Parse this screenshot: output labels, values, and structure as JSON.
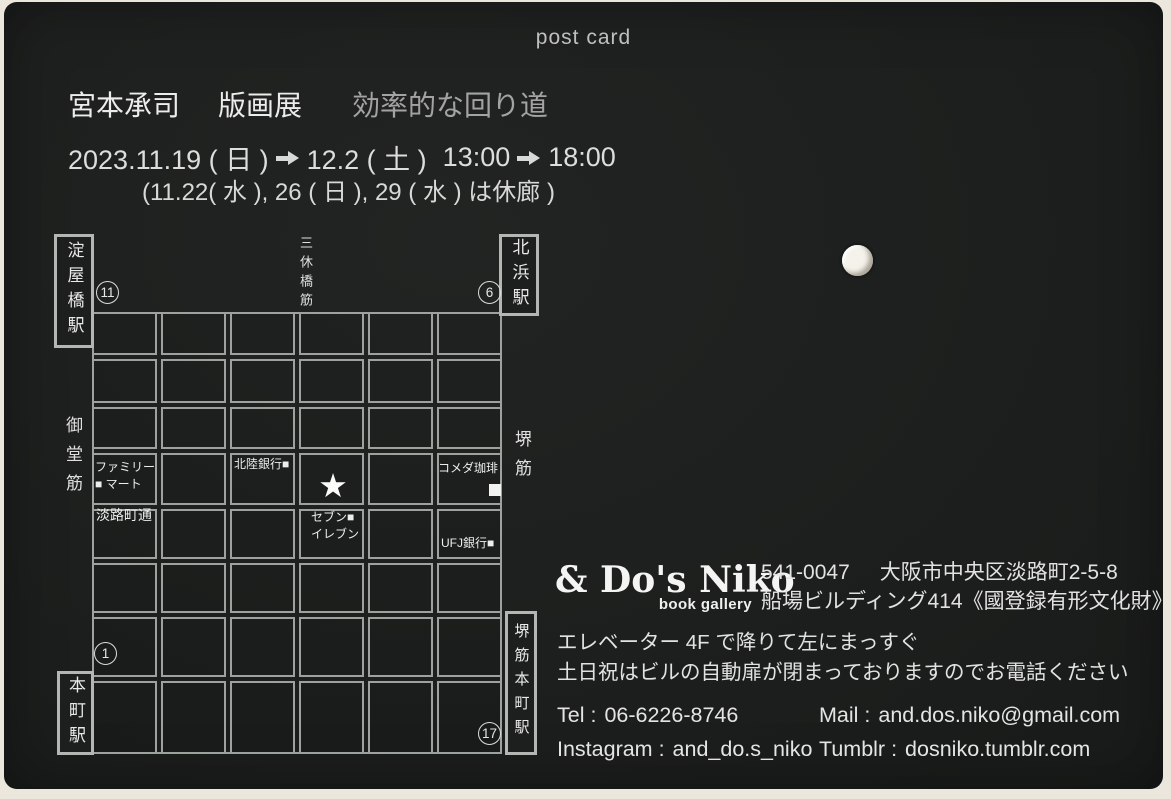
{
  "card": {
    "postcard_label": "post card",
    "title": {
      "artist": "宮本承司",
      "exhibition": "版画展",
      "subtitle": "効率的な回り道"
    },
    "dates": {
      "start": "2023.11.19 ( 日 )",
      "end": "12.2 ( 土 )",
      "open_time": "13:00",
      "close_time": "18:00",
      "closed_note": "(11.22( 水 ), 26 ( 日 ), 29 ( 水 ) は休廊 )"
    }
  },
  "map": {
    "stations": {
      "top_left": {
        "name": "淀屋橋駅",
        "exit": "11"
      },
      "top_right": {
        "name": "北浜駅",
        "exit": "6"
      },
      "bottom_left": {
        "name": "本町駅",
        "exit": "1"
      },
      "bottom_right": {
        "name": "堺筋本町駅",
        "exit": "17"
      }
    },
    "streets": {
      "center_vertical": "三休橋筋",
      "left_vertical": "御堂筋",
      "right_vertical": "堺筋",
      "cross_street": "淡路町通"
    },
    "landmarks": {
      "family_mart": {
        "line1": "ファミリー",
        "line2": "■ マート"
      },
      "hokuriku_bank": {
        "label": "北陸銀行■"
      },
      "komeda_coffee": {
        "label": "コメダ珈琲",
        "marker": "■"
      },
      "seven_eleven": {
        "line1": "セブン■",
        "line2": "イレブン"
      },
      "ufj_bank": {
        "label": "UFJ銀行■"
      },
      "venue_star": "★"
    }
  },
  "gallery": {
    "logo": "& Do's Niko",
    "logo_sub": "book gallery",
    "postal_code": "541-0047",
    "address_line1": "大阪市中央区淡路町2-5-8",
    "address_line2": "船場ビルディング414《國登録有形文化財》",
    "directions_line1": "エレベーター 4F で降りて左にまっすぐ",
    "directions_line2": "土日祝はビルの自動扉が閉まっておりますのでお電話ください",
    "contacts": {
      "tel_label": "Tel :",
      "tel_value": "06-6226-8746",
      "mail_label": "Mail :",
      "mail_value": "and.dos.niko@gmail.com",
      "instagram_label": "Instagram :",
      "instagram_value": "and_do.s_niko",
      "tumblr_label": "Tumblr :",
      "tumblr_value": "dosniko.tumblr.com"
    }
  }
}
